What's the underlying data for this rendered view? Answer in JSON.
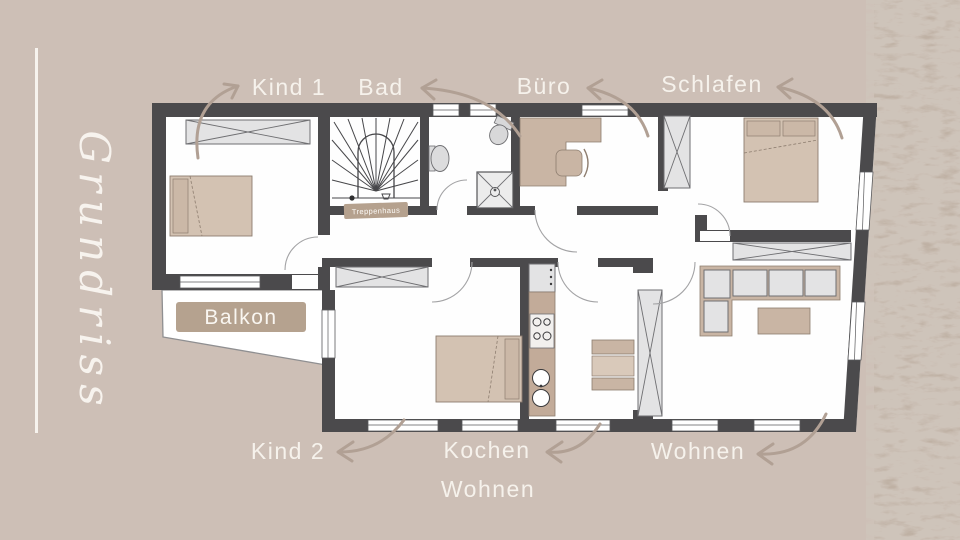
{
  "page": {
    "background_color": "#cdbfb6",
    "texture_band_color": "#b7a99d",
    "accent_line_color": "#f7f3ee",
    "label_color": "#f6f2ec",
    "arrow_color": "#b1a094",
    "wall_color": "#4b4a4c"
  },
  "title": {
    "script": "Grundriss"
  },
  "floorplan": {
    "room_labels": {
      "kind1": "Kind 1",
      "bad": "Bad",
      "buero": "Büro",
      "schlafen": "Schlafen",
      "kind2": "Kind 2",
      "kochen_line1": "Kochen",
      "kochen_line2": "Wohnen",
      "wohnen": "Wohnen",
      "balkon": "Balkon",
      "treppenhaus": "Treppenhaus"
    }
  }
}
